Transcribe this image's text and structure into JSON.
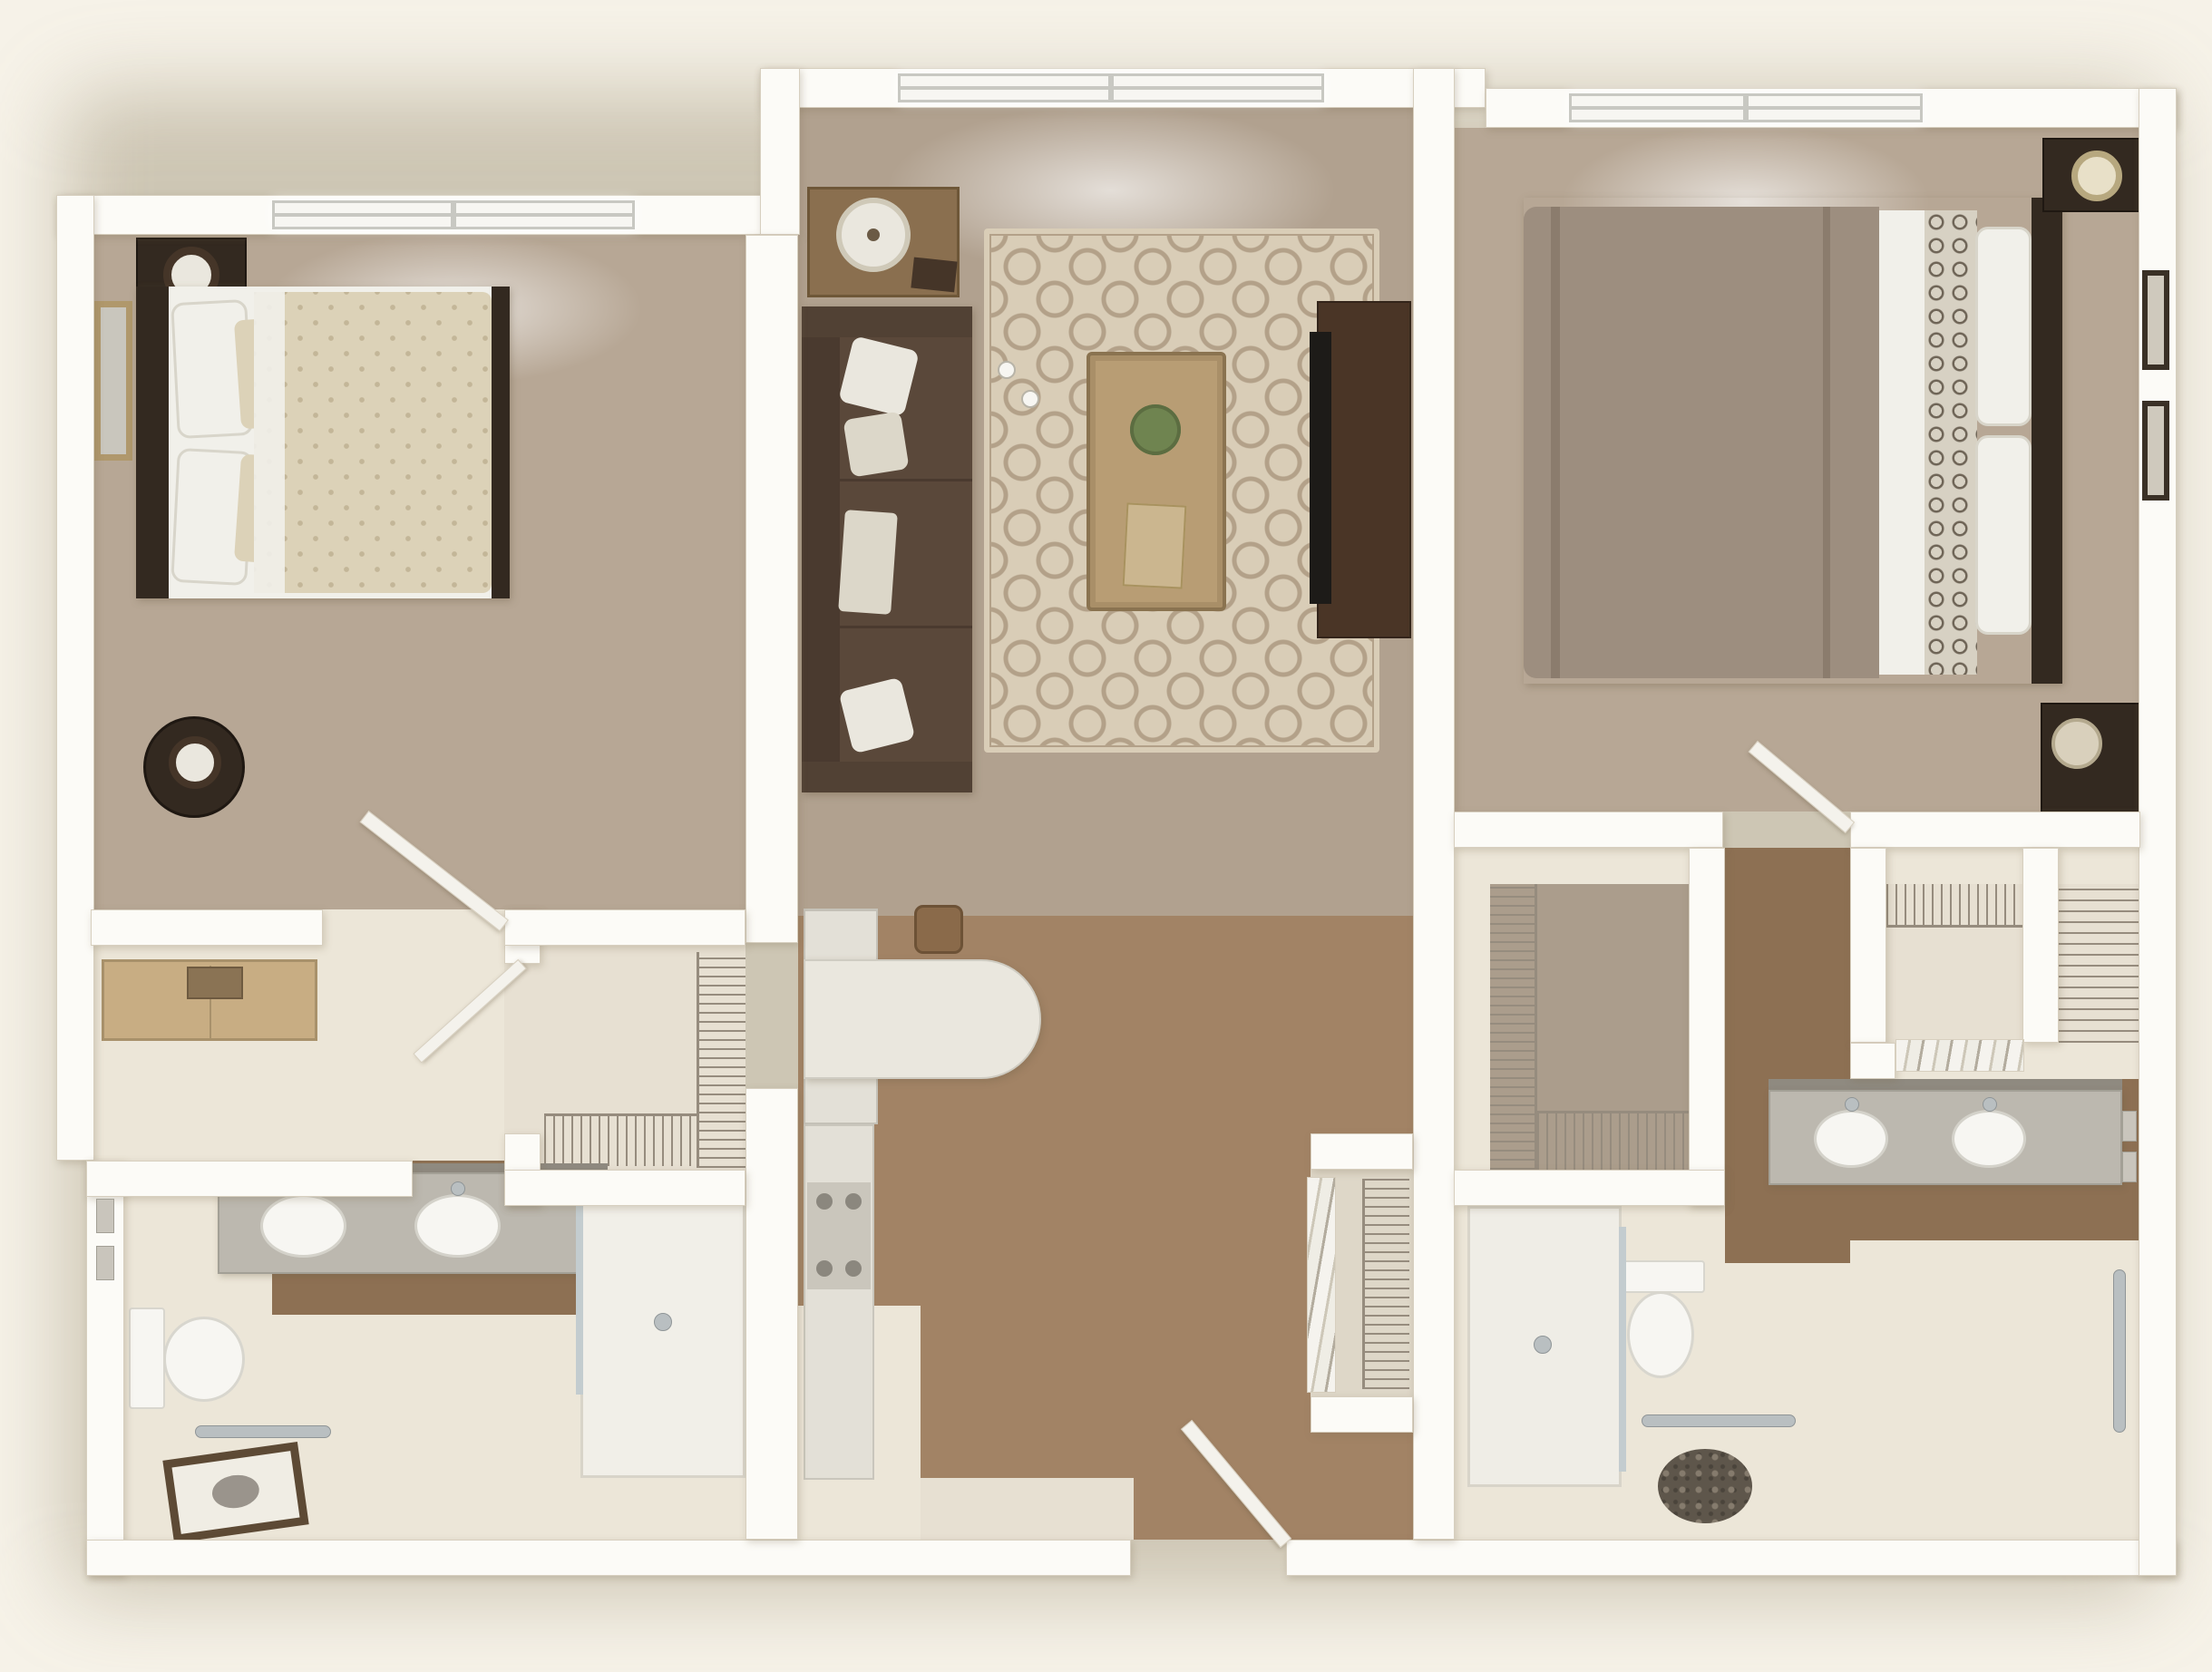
{
  "scene": {
    "kind": "3d-floor-plan-rendering",
    "view": "top-down dollhouse",
    "text_labels": [],
    "unit_summary": {
      "bedrooms": 2,
      "bathrooms": 2,
      "windows": 3,
      "closets": 5
    }
  },
  "palette": {
    "bg": "#f6f2e8",
    "wall": "#fcfbf7",
    "wallEdge": "#d7cfbf",
    "winFrame": "#c8c8c2",
    "white": "#f7f6f2",
    "doorLeaf": "#f4f2ec",
    "carpet": "#b7a795",
    "carpet2": "#b1a18f",
    "wood": "#a28365",
    "wood2": "#8d7053",
    "creamFloor": "#ece6d8",
    "creamFloor2": "#e7e0d2",
    "closetFloor": "#ab9d8c",
    "rugBase": "#d9cdb7",
    "rugPattern": "#b3a189",
    "sofa": "#5a483a",
    "sofaBack": "#4a3a2f",
    "sofaArm": "#514134",
    "pillow": "#eae7de",
    "pillow2": "#dcd7c9",
    "darkWood": "#332920",
    "darkWood2": "#453528",
    "bedCream": "#dcd2b8",
    "bedCreamDark": "#c3b698",
    "sheet": "#f1f0ea",
    "taupe": "#9d8e7f",
    "taupeDark": "#8b7c6d",
    "trellis": "#d7d1c3",
    "trellisDark": "#6f6557",
    "counter": "#eae7de",
    "counterGrey": "#bcb8af",
    "cooktop": "#cac6bc",
    "burner": "#8b877e",
    "steel": "#e3e0d7",
    "chrome": "#b9bfc1",
    "glass": "#c3cccf",
    "wire": "#968c7e",
    "plant": "#6f8450",
    "gold": "#b0986c",
    "woodLight": "#c8ad83",
    "tvBlack": "#1d1b18",
    "pebble": "#5e564b",
    "pebbleDot": "#857b6d",
    "mirrorGlass": "#c9c6bd",
    "artFrame": "#5d4a35"
  },
  "rooms": [
    {
      "id": "bedroom-1",
      "floor": "carpet",
      "features": [
        "window",
        "bed",
        "headboard",
        "pillows",
        "patterned-comforter",
        "nightstand",
        "table-lamp",
        "round-table-lamp",
        "wall-mirror",
        "dresser",
        "jewelry-box",
        "door"
      ]
    },
    {
      "id": "living-room",
      "floor": "carpet",
      "features": [
        "window",
        "sofa",
        "throw-pillows",
        "area-rug",
        "coffee-table",
        "potted-plant",
        "decor-tray",
        "cups",
        "side-table",
        "drum-lamp",
        "tv-stand",
        "television"
      ]
    },
    {
      "id": "bedroom-2",
      "floor": "carpet",
      "features": [
        "window",
        "bed",
        "headboard",
        "pillows",
        "taupe-comforter",
        "trellis-runner",
        "nightstand",
        "table-lamp",
        "storage-bench",
        "hat-box",
        "wall-art",
        "door"
      ]
    },
    {
      "id": "kitchen",
      "floor": "hardwood",
      "features": [
        "refrigerator",
        "peninsula-counter",
        "bar-stool",
        "base-cabinets",
        "cooktop"
      ]
    },
    {
      "id": "entry-hall",
      "floor": "hardwood",
      "features": [
        "entry-door",
        "threshold",
        "coat-closet-bifold",
        "wire-shelving"
      ]
    },
    {
      "id": "bathroom-1",
      "floor": "tile",
      "features": [
        "double-sink-vanity",
        "mirror",
        "faucets",
        "toilet",
        "walk-in-shower",
        "glass-panel",
        "grab-bar",
        "framed-art-on-floor",
        "light-switches",
        "wood-floor-strip"
      ]
    },
    {
      "id": "walk-in-closet-1",
      "floor": "tile",
      "features": [
        "wire-shelving",
        "closet-door"
      ]
    },
    {
      "id": "walk-in-closet-2",
      "floor": "carpet",
      "features": [
        "wire-shelving"
      ]
    },
    {
      "id": "bifold-closet",
      "floor": "tile",
      "features": [
        "bifold-louver-doors",
        "wire-shelf"
      ]
    },
    {
      "id": "linen-closet",
      "floor": "tile",
      "features": [
        "wire-shelving"
      ]
    },
    {
      "id": "bathroom-2",
      "floor": "tile",
      "features": [
        "double-sink-vanity",
        "mirror",
        "faucets",
        "toilet",
        "walk-in-shower",
        "glass-panel",
        "grab-bars",
        "pebble-rug",
        "light-switches",
        "wood-floor-strip"
      ]
    }
  ],
  "doors": [
    "entry-door",
    "bedroom-1-door",
    "bedroom-2-door",
    "closet-1-door",
    "bifold-doors",
    "entry-closet-bifold"
  ],
  "windows": [
    "bedroom-1-window",
    "living-room-window",
    "bedroom-2-window"
  ]
}
